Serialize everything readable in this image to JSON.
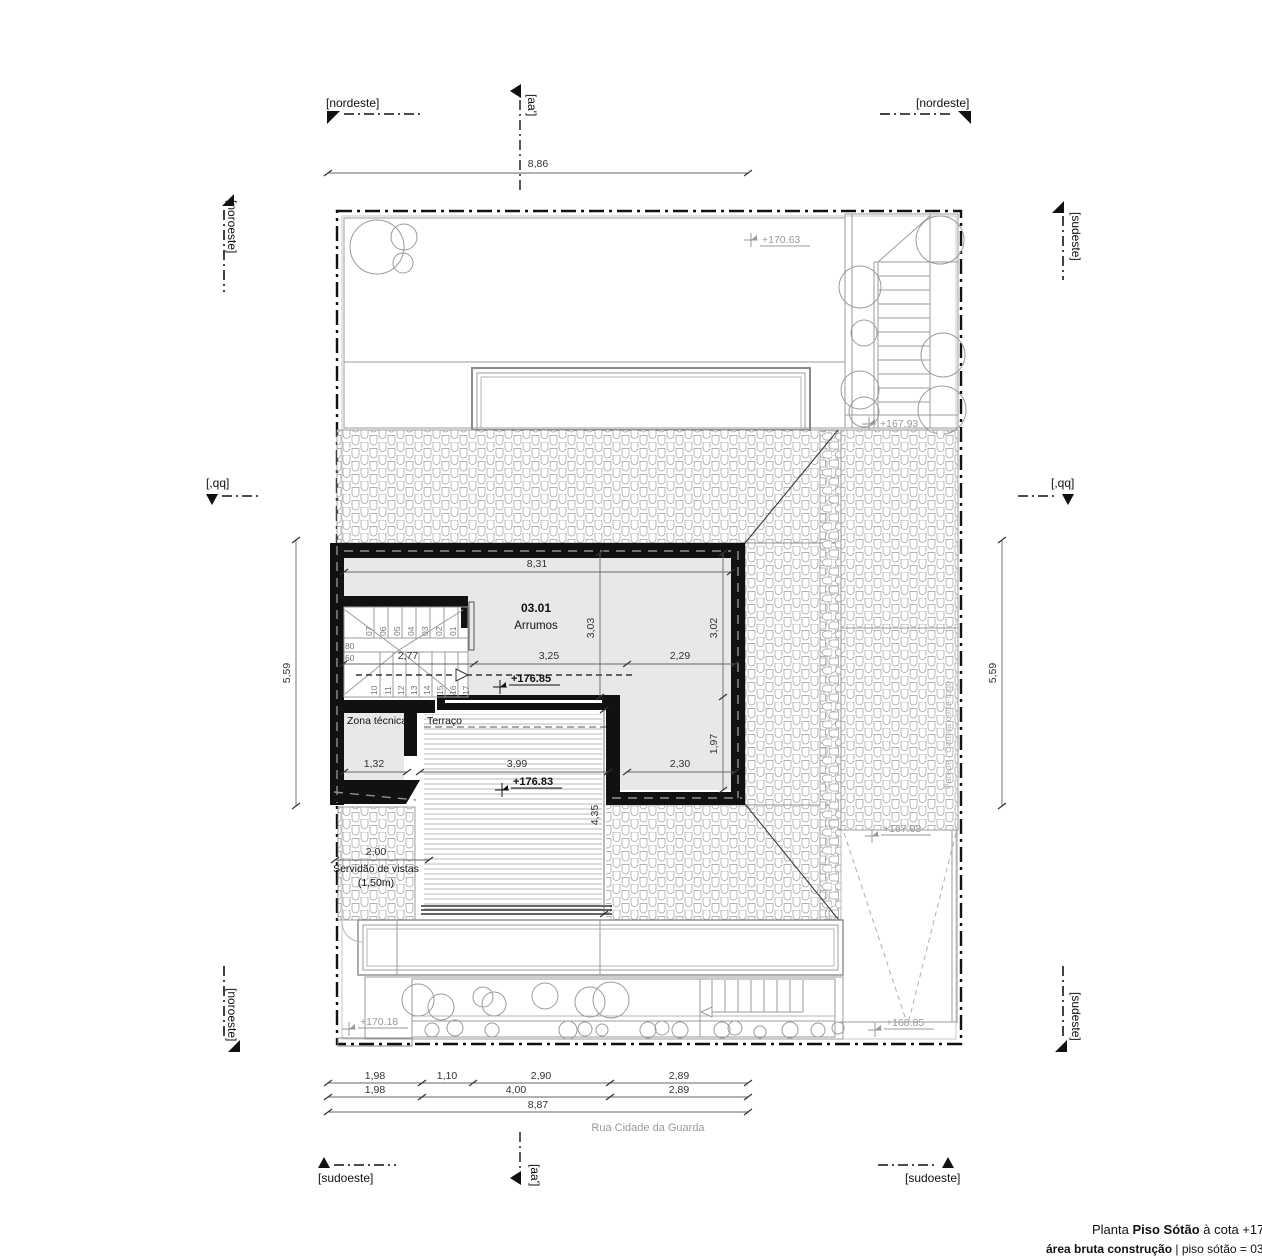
{
  "colors": {
    "wall": "#111111",
    "room_fill": "#e8e8e8",
    "line_gray": "#999999",
    "annotation_gray": "#9a9a9a",
    "dim_text": "#333333",
    "boundary": "#111111"
  },
  "compass": {
    "nordeste_top_left": "[nordeste]",
    "nordeste_top_right": "[nordeste]",
    "noroeste_upper": "[noroeste]",
    "noroeste_lower": "[noroeste]",
    "sudeste_upper": "[sudeste]",
    "sudeste_lower": "[sudeste]",
    "sudoeste_bottom_left": "[sudoeste]",
    "sudoeste_bottom_right": "[sudoeste]"
  },
  "sections": {
    "aa_top": "[aa']",
    "aa_bottom": "[aa']",
    "bb_left": "[,qq]",
    "bb_right": "[,qq]"
  },
  "rooms": {
    "number": "03.01",
    "name": "Arrumos",
    "zona_tecnica": "Zona técnica",
    "terraco": "Terraço",
    "servidao_1": "Servidão de vistas",
    "servidao_2": "(1,50m)",
    "firewall": "Parede | Cortina corta-fogo"
  },
  "levels": {
    "l170_63": "+170.63",
    "l167_93_top": "+167.93",
    "l176_85": "+176.85",
    "l176_83": "+176.83",
    "l167_93_mid": "+167.93",
    "l168_85": "+168.85",
    "l170_18": "+170.18"
  },
  "dimensions": {
    "top": "8,86",
    "side_left": "5,59",
    "side_right": "5,59",
    "room_width": "8,31",
    "d3_03": "3,03",
    "d3_02": "3,02",
    "d2_77": "2,77",
    "d3_25": "3,25",
    "d2_29": "2,29",
    "d1_97": "1,97",
    "d2_30": "2,30",
    "d1_32": "1,32",
    "d3_99": "3,99",
    "d4_35": "4,35",
    "d2_00": "2,00",
    "bottom_row1": [
      "1,98",
      "1,10",
      "2,90",
      "2,89"
    ],
    "bottom_row2": [
      "1,98",
      "4,00",
      "2,89"
    ],
    "bottom_total": "8,87"
  },
  "stairs": {
    "upper": [
      "07",
      "06",
      "05",
      "04",
      "03",
      "02",
      "01"
    ],
    "lower": [
      "10",
      "11",
      "12",
      "13",
      "14",
      "15",
      "16",
      "17"
    ],
    "landing": [
      "80",
      "60"
    ]
  },
  "street": "Rua Cidade da Guarda",
  "footer": {
    "p1": "Planta ",
    "p2": "Piso Sótão",
    "p3": " à cota +178",
    "p4": "área bruta construção",
    "p5": " | piso sótão = 03"
  }
}
